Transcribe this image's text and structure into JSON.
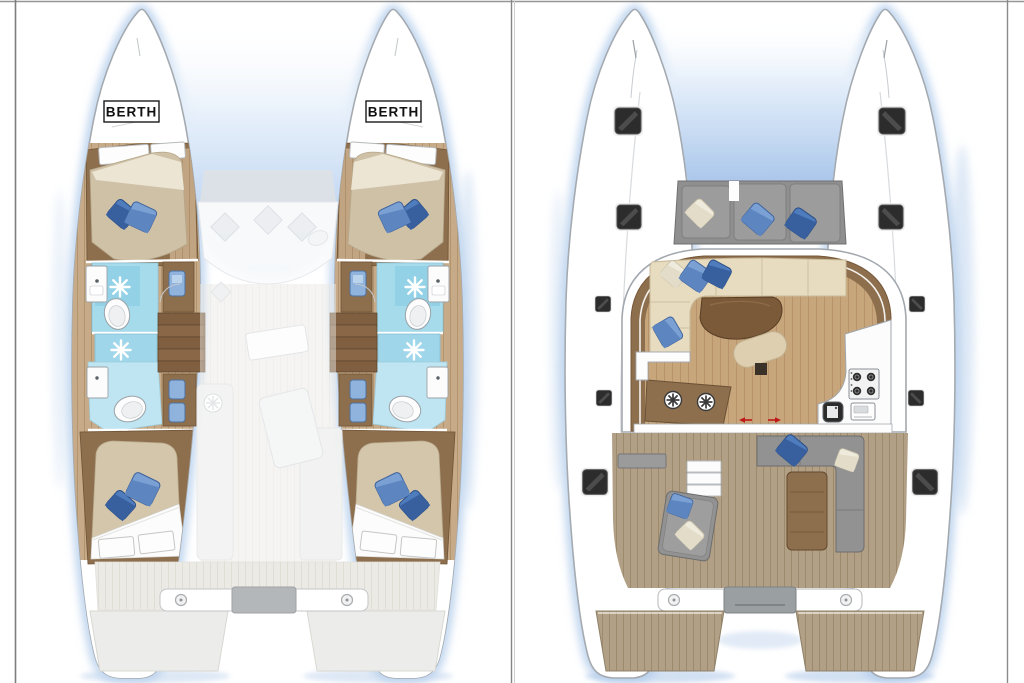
{
  "frame": {
    "background": "#ffffff",
    "border_color": "#7f7f7f"
  },
  "lower_deck_plan": {
    "berth_label_port": "BERTH",
    "berth_label_starboard": "BERTH"
  },
  "icons": {
    "shower_icon": "white sun-rays burst on blue floor",
    "toilet_icon": "white oval",
    "sink_icon": "white square with faucet dot",
    "deck_hatch_icon": "dark rounded square",
    "spoked_circle_icon": "white circle with dark spokes",
    "stove_icon": "four dark burners",
    "sliding_door_icon": "red double arrow",
    "pillow_icon": "rotated blue square"
  },
  "colors": {
    "hull_outline": "#a4aab0",
    "glow_blue": "#b5cfec",
    "bridge_shadow_blue": "#a9c6ea",
    "wood_dark": "#8d6f4e",
    "wood_floor": "#c7ab88",
    "mattress_tan": "#cfc1a6",
    "pillow_blue_dark": "#3f6db0",
    "pillow_blue_light": "#6e97cf",
    "bathroom_blue": "#a6dbec",
    "bathroom_blue_light": "#bfe5f2",
    "ghost_gray": "#eceae5",
    "teak_deck": "#b2a086",
    "seat_gray": "#929292",
    "settee_beige": "#e7dbc0",
    "table_brown": "#7b5a3a",
    "saloon_floor": "#c8a67c",
    "hatch_dark": "#2c2c2c",
    "arrow_red": "#c01818"
  }
}
